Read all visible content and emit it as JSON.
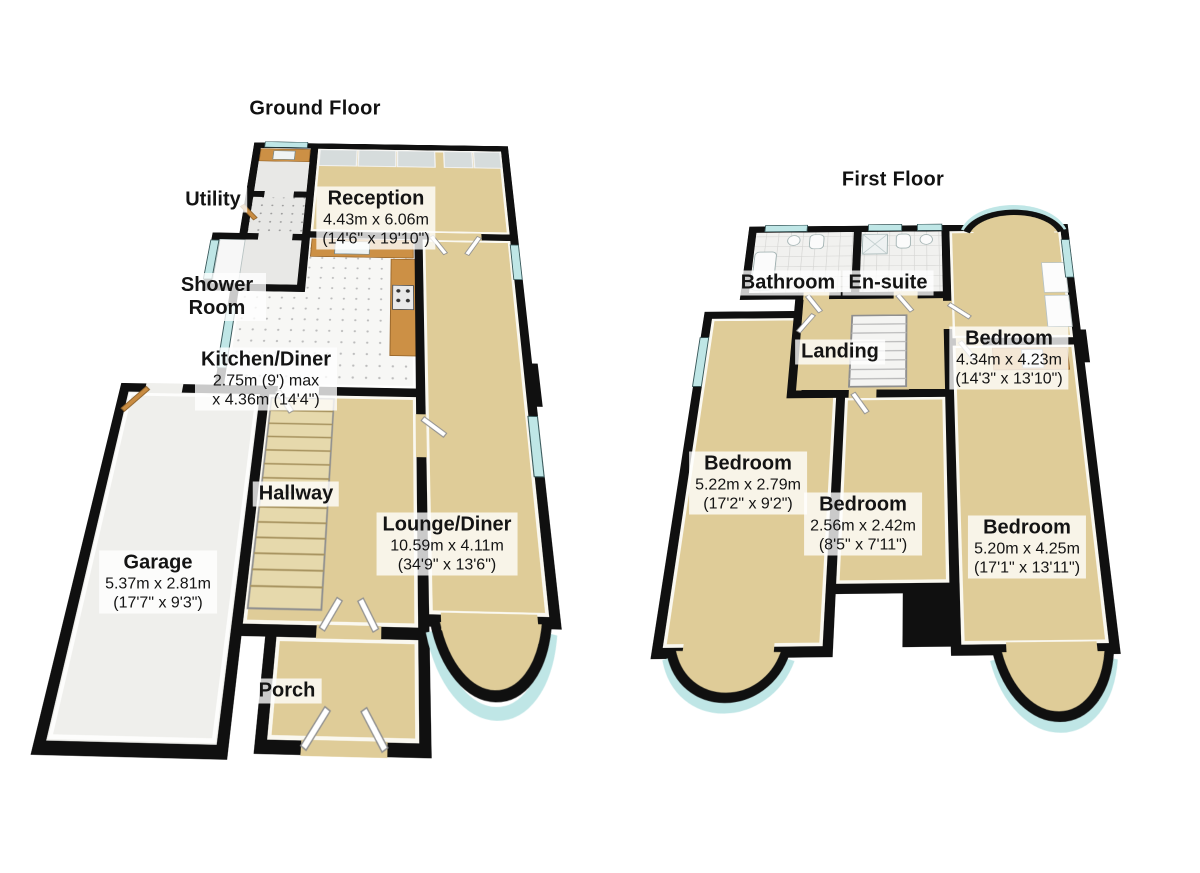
{
  "ground_floor": {
    "title": "Ground Floor",
    "rooms": {
      "utility": {
        "name": "Utility"
      },
      "reception": {
        "name": "Reception",
        "metric": "4.43m x 6.06m",
        "imperial": "(14'6\" x 19'10\")"
      },
      "shower": {
        "name": "Shower Room"
      },
      "kitchen": {
        "name": "Kitchen/Diner",
        "metric": "2.75m (9') max",
        "imperial": "x 4.36m (14'4\")"
      },
      "hallway": {
        "name": "Hallway"
      },
      "garage": {
        "name": "Garage",
        "metric": "5.37m x 2.81m",
        "imperial": "(17'7\" x 9'3\")"
      },
      "lounge": {
        "name": "Lounge/Diner",
        "metric": "10.59m x 4.11m",
        "imperial": "(34'9\" x 13'6\")"
      },
      "porch": {
        "name": "Porch"
      }
    }
  },
  "first_floor": {
    "title": "First Floor",
    "rooms": {
      "bathroom": {
        "name": "Bathroom"
      },
      "ensuite": {
        "name": "En-suite"
      },
      "landing": {
        "name": "Landing"
      },
      "bedroom_rear": {
        "name": "Bedroom",
        "metric": "4.34m x 4.23m",
        "imperial": "(14'3\" x 13'10\")"
      },
      "bedroom_left": {
        "name": "Bedroom",
        "metric": "5.22m x 2.79m",
        "imperial": "(17'2\" x 9'2\")"
      },
      "bedroom_middle": {
        "name": "Bedroom",
        "metric": "2.56m x 2.42m",
        "imperial": "(8'5\" x 7'11\")"
      },
      "bedroom_front": {
        "name": "Bedroom",
        "metric": "5.20m x 4.25m",
        "imperial": "(17'1\" x 13'11\")"
      }
    }
  },
  "colors": {
    "wall": "#101010",
    "floor": "#dfcc98",
    "garage": "#efefec",
    "tile": "#f1f1ef",
    "glass": "#bfe6e6",
    "counter_wood": "#cc9045",
    "label_bg": "rgba(255,255,255,0.78)",
    "label_text": "#141414"
  }
}
